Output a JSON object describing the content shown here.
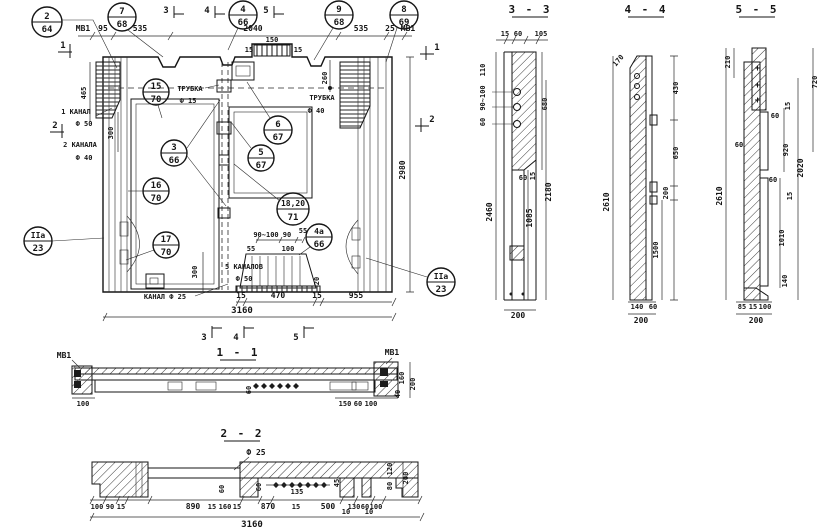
{
  "callouts": [
    {
      "n": "2",
      "d": "64"
    },
    {
      "n": "7",
      "d": "68"
    },
    {
      "n": "4",
      "d": "66"
    },
    {
      "n": "9",
      "d": "68"
    },
    {
      "n": "8",
      "d": "69"
    },
    {
      "n": "15",
      "d": "70"
    },
    {
      "n": "3",
      "d": "66"
    },
    {
      "n": "6",
      "d": "67"
    },
    {
      "n": "5",
      "d": "67"
    },
    {
      "n": "16",
      "d": "70"
    },
    {
      "n": "17",
      "d": "70"
    },
    {
      "n": "18,20",
      "d": "71"
    },
    {
      "n": "4а",
      "d": "66"
    },
    {
      "n": "IIа",
      "d": "23"
    },
    {
      "n": "IIа",
      "d": "23"
    }
  ],
  "marks": {
    "s1": "1",
    "s2": "2",
    "s3": "3",
    "s4": "4",
    "s5": "5"
  },
  "mv": {
    "top": {
      "mb1l": "МВ1",
      "d95": "95",
      "d535l": "535",
      "d2040": "2040",
      "d535r": "535",
      "d25": "25",
      "mb1r": "МВ1",
      "d15a": "15",
      "d150": "150",
      "d15b": "15"
    },
    "left": {
      "d465": "465",
      "kanal1": "1 КАНАЛ",
      "kanal1d": "Ф 50",
      "kanal2": "2 КАНАЛА",
      "kanal2d": "Ф 40",
      "d300": "300"
    },
    "mid": {
      "trubka15": "ТРУБКА",
      "trubka15d": "Ф 15",
      "trubka40": "ТРУБКА",
      "trubka40d": "Ф 40",
      "d260": "260"
    },
    "bottom": {
      "d300": "300",
      "kanal5": "5 КАНАЛОВ",
      "kanal5d": "Ф 50",
      "kanal25": "КАНАЛ Ф 25",
      "d90_100": "90~100",
      "d90": "90",
      "d55a": "55",
      "d55b": "55",
      "d100": "100",
      "d20": "20",
      "d15a": "15",
      "d470": "470",
      "d15b": "15",
      "d955": "955",
      "d3160": "3160"
    },
    "right": {
      "d2980": "2980"
    }
  },
  "s33": {
    "title": "3 - 3",
    "top": [
      "15",
      "60",
      "105"
    ],
    "left": [
      "110",
      "90~100",
      "60"
    ],
    "d680": "680",
    "d60": "60",
    "d15": "15",
    "d2460": "2460",
    "d1085": "1085",
    "d2180": "2180",
    "d200": "200"
  },
  "s44": {
    "title": "4 - 4",
    "d170": "170",
    "d430": "430",
    "d650": "650",
    "d200a": "200",
    "d1500": "1500",
    "d2610": "2610",
    "d140": "140",
    "d60": "60",
    "d200b": "200"
  },
  "s55": {
    "title": "5 - 5",
    "d210": "210",
    "d720": "720",
    "d15a": "15",
    "d60a": "60",
    "d60b": "60",
    "d920": "920",
    "d2020": "2020",
    "d2610": "2610",
    "d60c": "60",
    "d15b": "15",
    "d1010": "1010",
    "d140": "140",
    "d85": "85",
    "d15c": "15",
    "d100": "100",
    "d200": "200"
  },
  "s11": {
    "title": "1 - 1",
    "mb1l": "МВ1",
    "mb1r": "МВ1",
    "d100l": "100",
    "d60": "60",
    "d150": "150",
    "d60r": "60",
    "d100r": "100",
    "d160": "160",
    "d40": "40",
    "d200": "200"
  },
  "s22": {
    "title": "2 - 2",
    "f25": "Ф 25",
    "d60a": "60",
    "d60b": "60",
    "d135": "135",
    "d45": "45",
    "row": [
      "100",
      "90",
      "15",
      "890",
      "15",
      "160",
      "15",
      "870",
      "15",
      "500",
      "130",
      "60",
      "100"
    ],
    "d10a": "10",
    "d10b": "10",
    "d3160": "3160",
    "d120": "120",
    "d80": "80",
    "d200": "200"
  }
}
